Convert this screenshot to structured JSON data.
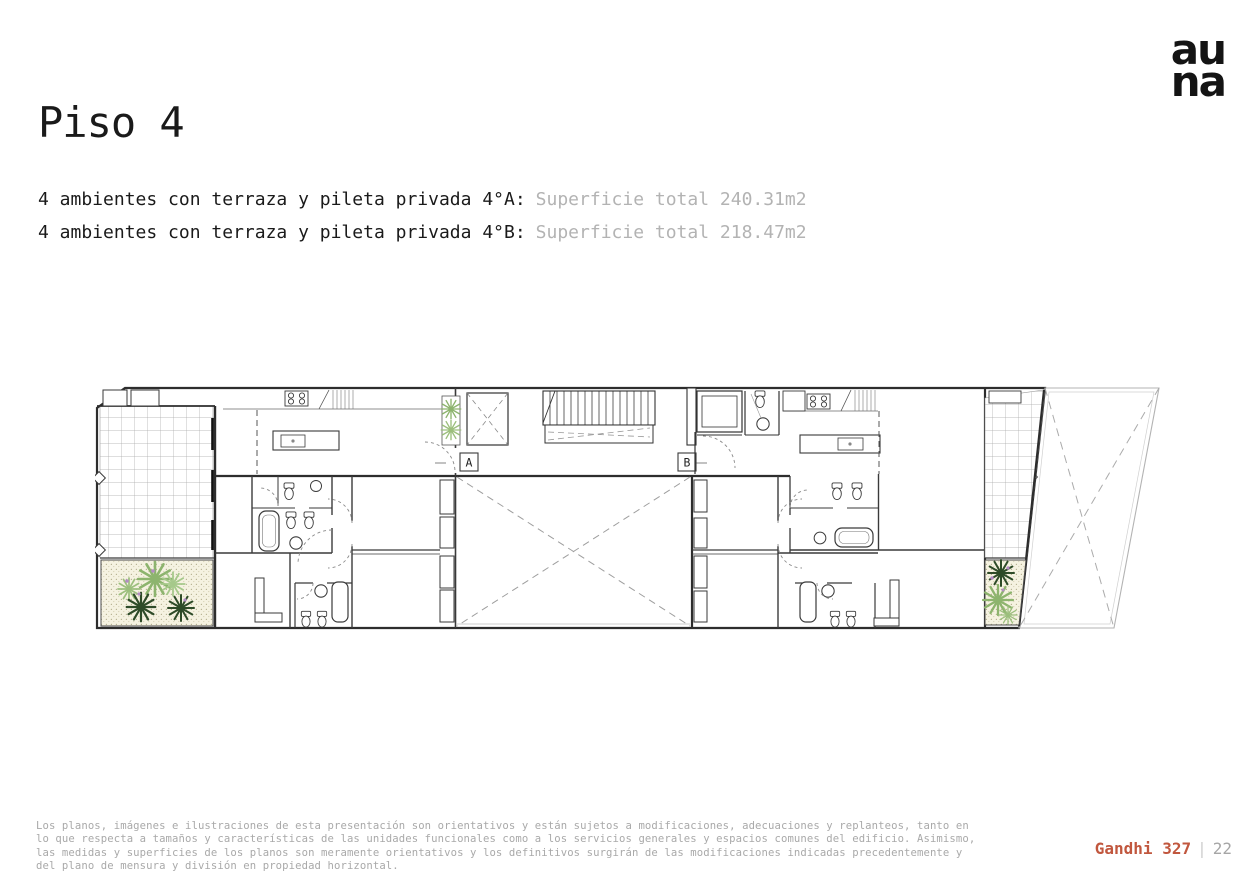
{
  "logo": {
    "line1": "au",
    "line2": "na"
  },
  "title": "Piso 4",
  "units": [
    {
      "label": "4 ambientes con terraza y pileta privada 4°A:",
      "value": "Superficie total 240.31m2"
    },
    {
      "label": "4 ambientes con terraza y pileta privada 4°B:",
      "value": "Superficie total 218.47m2"
    }
  ],
  "floorplan": {
    "marker_a": "A",
    "marker_b": "B"
  },
  "footer": {
    "disclaimer": "Los planos, imágenes e ilustraciones de esta presentación son orientativos y están sujetos a modificaciones, adecuaciones y replanteos, tanto en\nlo que respecta a tamaños y características de las unidades funcionales como a los servicios generales y espacios comunes del edificio. Asimismo,\nlas medidas y superficies de los planos son meramente orientativos y los definitivos surgirán de las modificaciones indicadas precedentemente y\ndel plano de mensura y división en propiedad horizontal.",
    "project": "Gandhi 327",
    "separator": "|",
    "page_number": "22"
  },
  "colors": {
    "accent": "#c1573e",
    "muted_value_text": "#b3b3b3",
    "disclaimer_text": "#a9a9a9",
    "plan_line": "#2d2d2d",
    "plant_light": "#8db46e",
    "plant_dark": "#2e4b28",
    "planter_bg": "#f5f2e1"
  }
}
